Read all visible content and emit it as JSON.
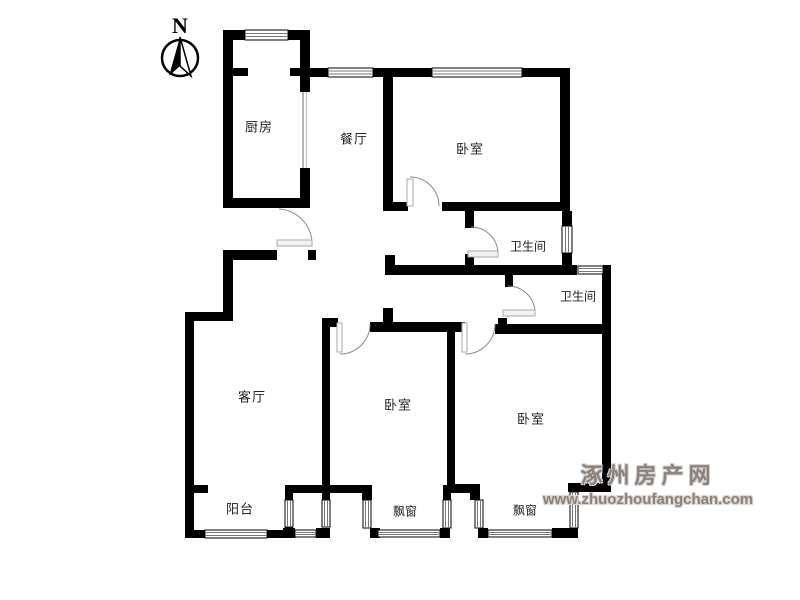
{
  "compass": {
    "letter": "N"
  },
  "rooms": {
    "kitchen": "厨房",
    "dining": "餐厅",
    "bedroom_top": "卧室",
    "bathroom_upper": "卫生间",
    "bathroom_lower": "卫生间",
    "living": "客厅",
    "bedroom_middle": "卧室",
    "bedroom_right": "卧室",
    "balcony": "阳台",
    "bay_window_middle": "飘窗",
    "bay_window_right": "飘窗"
  },
  "watermark": {
    "line1": "涿州房产网",
    "line2": "www.zhuozhoufangchan.com"
  },
  "colors": {
    "wall": "#000000",
    "door_leaf_fill": "#f2f2f2",
    "door_leaf_stroke": "#aaaaaa",
    "door_arc": "#888888",
    "watermark": "#8b827f",
    "background": "#ffffff"
  }
}
